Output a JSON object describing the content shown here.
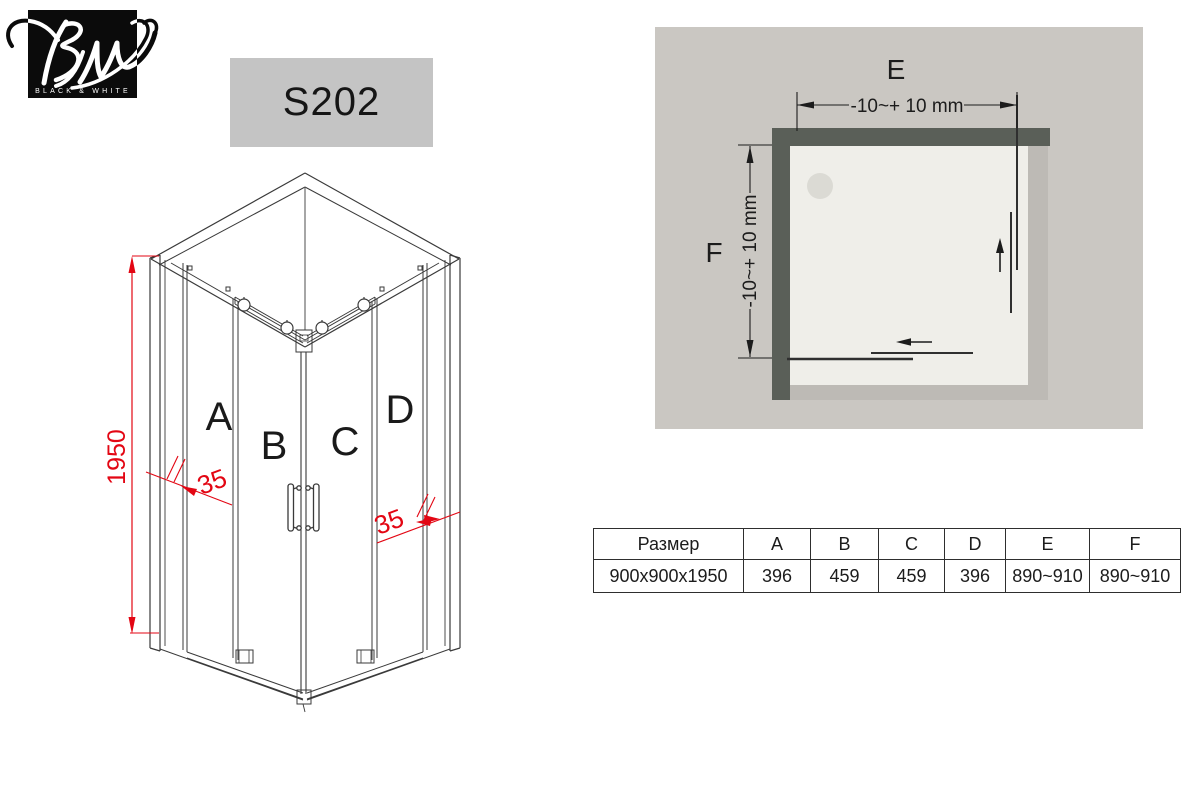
{
  "logo": {
    "monogram": "BW",
    "brand": "BLACK & WHITE"
  },
  "model_label": "S202",
  "iso_drawing": {
    "height_dim": "1950",
    "glass_dim_left": "35",
    "glass_dim_right": "35",
    "panels": {
      "a": "A",
      "b": "B",
      "c": "C",
      "d": "D"
    }
  },
  "plan_diagram": {
    "width_label": "E",
    "depth_label": "F",
    "width_tolerance": "-10~+ 10 mm",
    "depth_tolerance": "-10~+ 10 mm"
  },
  "spec_table": {
    "headers": [
      "Размер",
      "A",
      "B",
      "C",
      "D",
      "E",
      "F"
    ],
    "row": [
      "900x900x1950",
      "396",
      "459",
      "459",
      "396",
      "890~910",
      "890~910"
    ]
  },
  "colors": {
    "accent_red": "#e30613",
    "line_dark": "#3a3a3a",
    "wall_gray": "#5a5f58",
    "plan_background": "#cac7c2",
    "tray": "#efeee9",
    "model_box": "#c4c4c4"
  }
}
